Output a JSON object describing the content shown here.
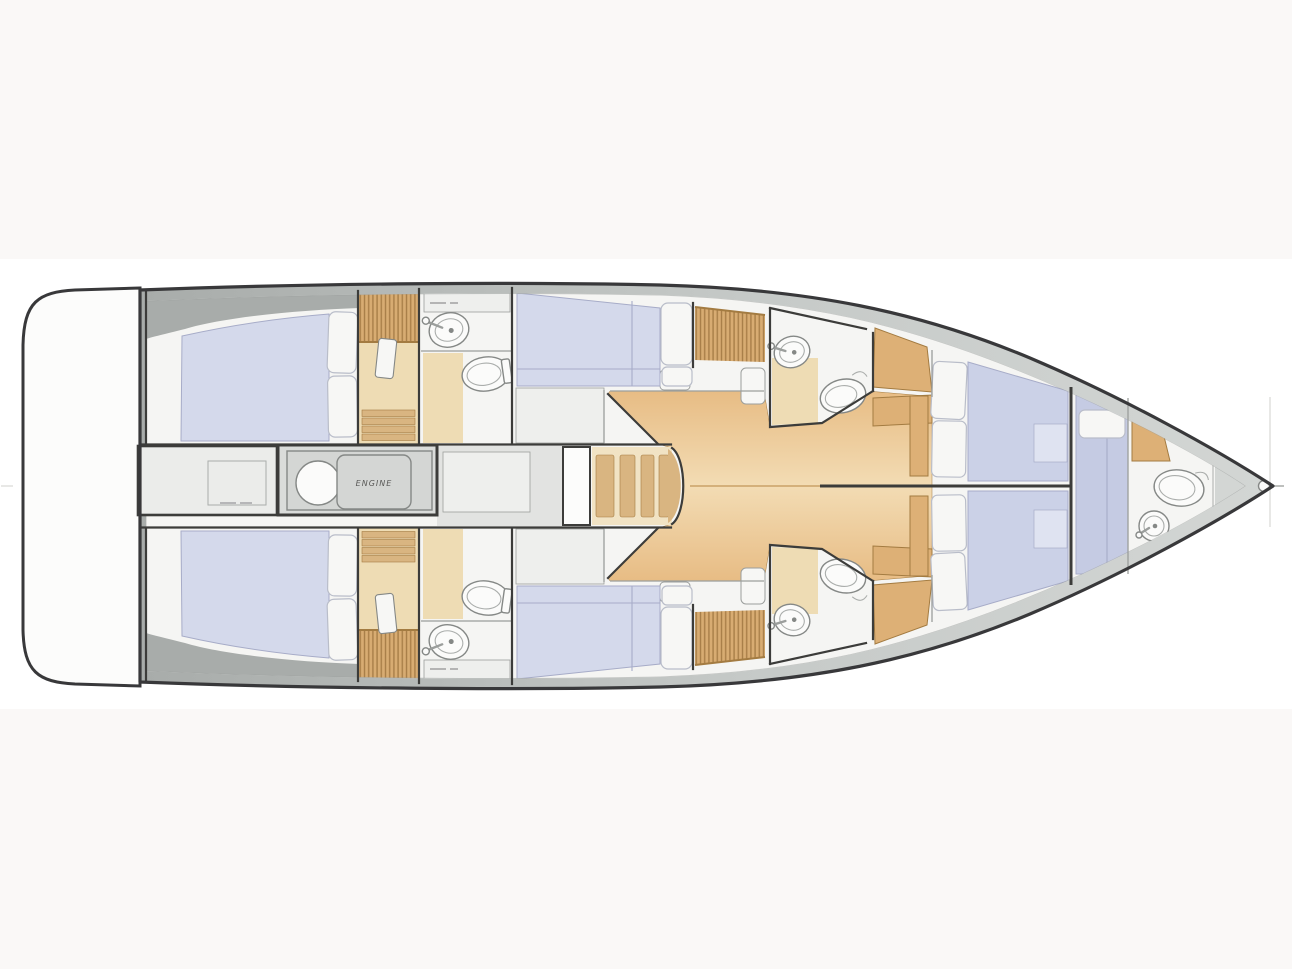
{
  "labels": {
    "engine": "ENGINE"
  },
  "diagram": {
    "type": "yacht-interior-floor-plan",
    "orientation": "bow-pointing-right",
    "rooms": [
      {
        "name": "swim-platform",
        "position": "stern"
      },
      {
        "name": "aft-cabin-port",
        "features": [
          "double-berth",
          "two-pillows"
        ]
      },
      {
        "name": "aft-cabin-starboard",
        "features": [
          "double-berth",
          "two-pillows"
        ]
      },
      {
        "name": "aft-storage-locker",
        "features": [
          "hatch-panel"
        ]
      },
      {
        "name": "engine-room",
        "label": "ENGINE",
        "features": [
          "engine-block",
          "flywheel"
        ]
      },
      {
        "name": "aft-companionway-port",
        "features": [
          "slatted-hatch",
          "door",
          "steps"
        ]
      },
      {
        "name": "aft-companionway-starboard",
        "features": [
          "slatted-hatch",
          "door",
          "steps"
        ]
      },
      {
        "name": "head-aft-port",
        "features": [
          "sink",
          "toilet",
          "shelf"
        ]
      },
      {
        "name": "head-aft-starboard",
        "features": [
          "sink",
          "toilet",
          "shelf"
        ]
      },
      {
        "name": "cabin-mid-port",
        "features": [
          "double-berth",
          "two-pillows"
        ]
      },
      {
        "name": "cabin-mid-starboard",
        "features": [
          "double-berth",
          "two-pillows"
        ]
      },
      {
        "name": "salon",
        "features": [
          "wood-floor",
          "companionway-steps",
          "stools"
        ]
      },
      {
        "name": "head-mid-port",
        "features": [
          "sink",
          "toilet"
        ]
      },
      {
        "name": "head-mid-starboard",
        "features": [
          "sink",
          "toilet"
        ]
      },
      {
        "name": "desk-port",
        "features": [
          "wood-desk",
          "seat"
        ]
      },
      {
        "name": "desk-starboard",
        "features": [
          "wood-desk",
          "seat"
        ]
      },
      {
        "name": "forward-cabin",
        "features": [
          "twin-berths",
          "four-pillows",
          "center-partition"
        ]
      },
      {
        "name": "bow-cabin",
        "features": [
          "athwartship-berth",
          "pillow"
        ]
      },
      {
        "name": "bow-head",
        "features": [
          "sink",
          "toilet",
          "wood-shelf"
        ]
      }
    ],
    "icon_names": [
      "toilet-icon",
      "sink-icon",
      "engine-flywheel-icon",
      "steps-icon",
      "bow-roller-icon"
    ]
  },
  "colors": {
    "page_bg": "#faf8f7",
    "panel_bg": "#ffffff",
    "hull_outline": "#38383a",
    "deck_gray": "#a8acaa",
    "deck_gray_mid": "#c6cac8",
    "deck_gray_light": "#d3d6d4",
    "interior_white": "#f5f5f3",
    "corridor_gray": "#e2e3e1",
    "corridor_inner": "#eeefed",
    "wall_dark": "#3c3c3a",
    "wall_light": "#9b9e9c",
    "mattress": "#d4d9eb",
    "mattress_fwd": "#cbd1e7",
    "mattress_bow": "#c5cbe3",
    "mattress_patch": "#dfe3f1",
    "mattress_stroke": "#a7acc8",
    "pillow": "#f7f7f5",
    "pillow_stroke": "#b9bdc9",
    "wood": "#e7bc84",
    "wood_light": "#f3dcb4",
    "wood_desk": "#ddb076",
    "wood_edge": "#a37b41",
    "wood_slat": "#d8ac72",
    "wood_slat_line": "#a87e48",
    "wood_step": "#d9b581",
    "wood_seam": "#c9a268",
    "steps_base": "#f1e3c4",
    "beige_floor": "#eedcb4",
    "fixture_fill": "#fbfbfa",
    "fixture_stroke": "#858886",
    "fixture_inner": "#aaadab",
    "engine_box": "#dadcda",
    "engine_frame": "#d4d6d4",
    "engine_text": "#5a5a58",
    "locker": "#ebecea",
    "platform": "#fcfcfb",
    "tiny_text": "#a0a0a2"
  }
}
